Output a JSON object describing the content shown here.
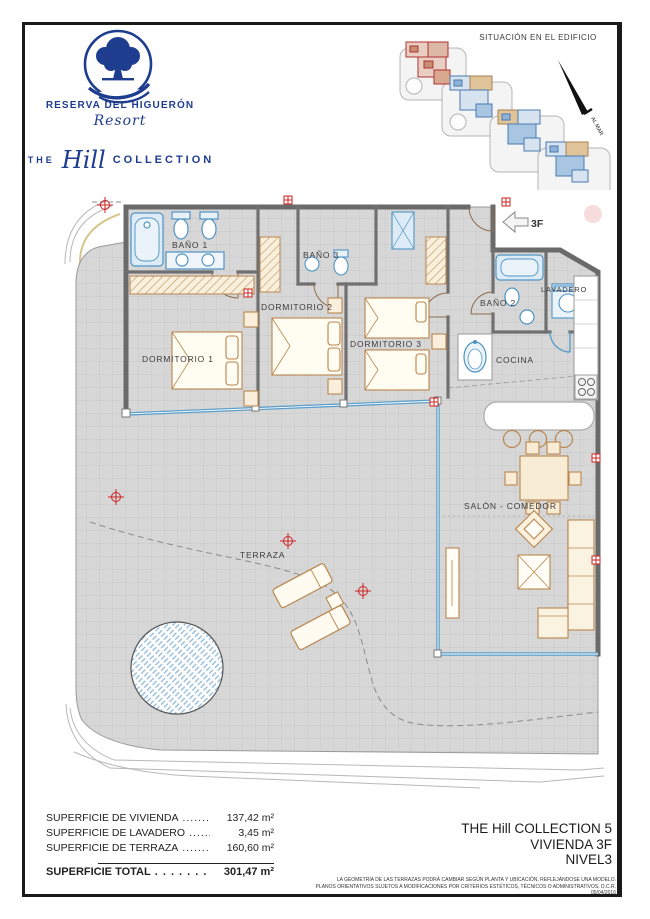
{
  "brand": {
    "name": "RESERVA DEL HIGUERÓN",
    "resort_script": "Resort",
    "collection_prefix": "THE",
    "collection_script": "Hill",
    "collection_suffix": "COLLECTION"
  },
  "situation": {
    "title": "SITUACIÓN EN EL EDIFICIO",
    "arrow_label": "AL MAR"
  },
  "plan": {
    "entry_label": "3F",
    "rooms": {
      "bano1": "BAÑO 1",
      "bano2": "BAÑO 2",
      "bano3": "BAÑO 3",
      "dorm1": "DORMITORIO 1",
      "dorm2": "DORMITORIO 2",
      "dorm3": "DORMITORIO 3",
      "lavadero": "LAVADERO",
      "cocina": "COCINA",
      "salon": "SALÓN - COMEDOR",
      "terraza": "TERRAZA"
    }
  },
  "areas": {
    "rows": [
      {
        "label": "SUPERFICIE DE VIVIENDA",
        "dots": "..............",
        "value": "137,42 m²"
      },
      {
        "label": "SUPERFICIE DE LAVADERO",
        "dots": ".............",
        "value": "3,45 m²"
      },
      {
        "label": "SUPERFICIE DE TERRAZA",
        "dots": "...............",
        "value": "160,60 m²"
      }
    ],
    "total": {
      "label": "SUPERFICIE TOTAL",
      "dots": ". . . . . . . . . .",
      "value": "301,47 m²"
    }
  },
  "unit": {
    "line1": "THE Hill COLLECTION 5",
    "line2": "VIVIENDA 3F",
    "line3": "NIVEL3"
  },
  "disclaimer": {
    "line1": "LA GEOMETRÍA DE LAS TERRAZAS PODRÁ CAMBIAR SEGÚN PLANTA Y UBICACIÓN, REFLEJÁNDOSE UNA MODELO.",
    "line2": "PLANOS ORIENTATIVOS SUJETOS A MODIFICACIONES POR CRITERIOS ESTÉTICOS, TÉCNICOS O ADMINISTRATIVOS. D.C.R. 05/04/2016"
  },
  "colors": {
    "brand_navy": "#1e3d8f",
    "wall_gray": "#6a6a6a",
    "floor_gray": "#d7d7d7",
    "window_blue": "#5b9ec9",
    "fixture_blue": "#4f94c4",
    "furniture_tan": "#b9854e",
    "marker_red": "#cc2222",
    "highlight_red": "#b03030"
  }
}
